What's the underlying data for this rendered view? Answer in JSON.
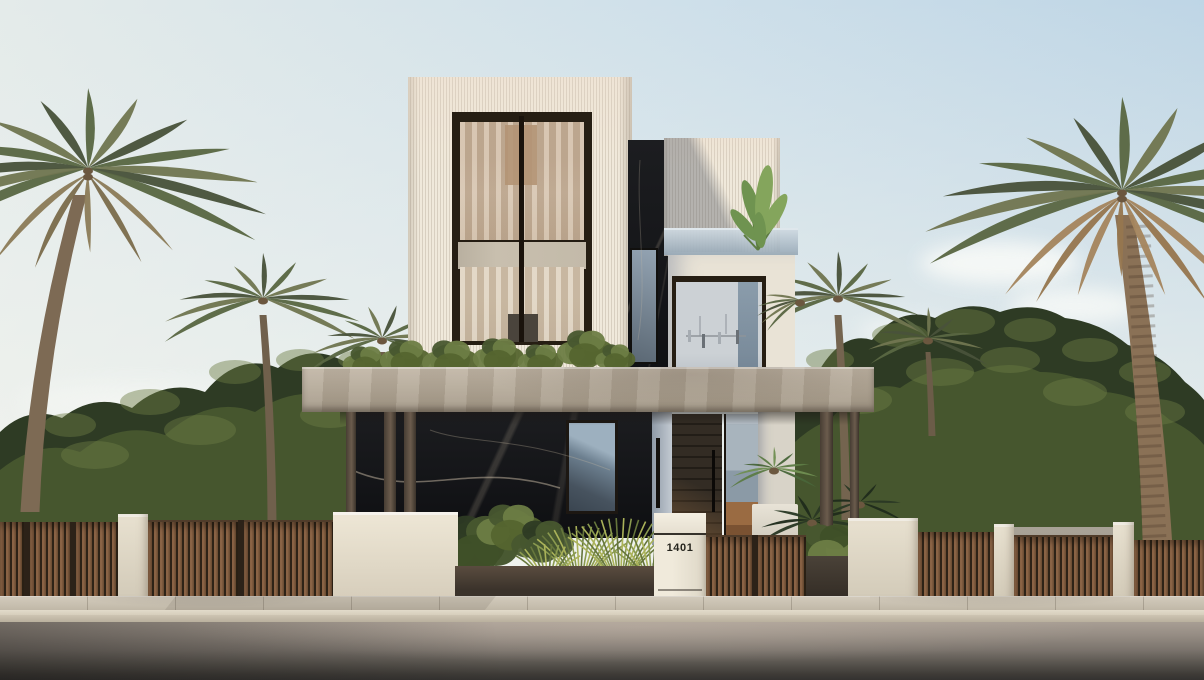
{
  "scene": {
    "type": "architectural-exterior-render",
    "description": "Modern three-storey villa with fluted cream facade, dark marble accents, concrete entrance canopy, timber slat fencing, palm trees, sidewalk and street",
    "house_number": "1401"
  },
  "palette": {
    "sky_left": "#e4ebea",
    "sky_top": "#cfe0ea",
    "sky_right": "#b9d2e4",
    "cloud": "#fafbf8",
    "foliage_dark": "#2e3b24",
    "foliage_mid": "#48572f",
    "foliage_light": "#6d7d44",
    "grass_light": "#aab259",
    "grass_mid": "#8a9a4f",
    "grass_dark": "#66763c",
    "palm_green": "#5a6743",
    "palm_olive": "#707650",
    "palm_deep": "#49523a",
    "palm_dry": "#a4855e",
    "palm_trunk": "#8a7156",
    "palm_trunk_dark": "#6b573f",
    "facade_cream": "#ece5d7",
    "concrete_canopy": "#b2a796",
    "marble_dark": "#17181b",
    "marble_vein": "#c9bca6",
    "frame_bronze": "#261e13",
    "glass_warm": "#c3ab90",
    "glass_cool": "#c9cfd4",
    "glass_blue": "#7d8da0",
    "door_wood": "#2c251d",
    "floor_wood": "#9a6b42",
    "fence_wood": "#7c5b40",
    "pier_light": "#dcd5c4",
    "wall_grey": "#9d978c",
    "pavement": "#c9c1b2",
    "curb": "#ded6c5",
    "road_light": "#a39a90",
    "road_dark": "#3c3a36",
    "number_color": "#26251e",
    "banana_green": "#6f9350",
    "banana_light": "#84a55c",
    "shade_green": "#2a3824",
    "shade_green2": "#1f2c1c"
  }
}
